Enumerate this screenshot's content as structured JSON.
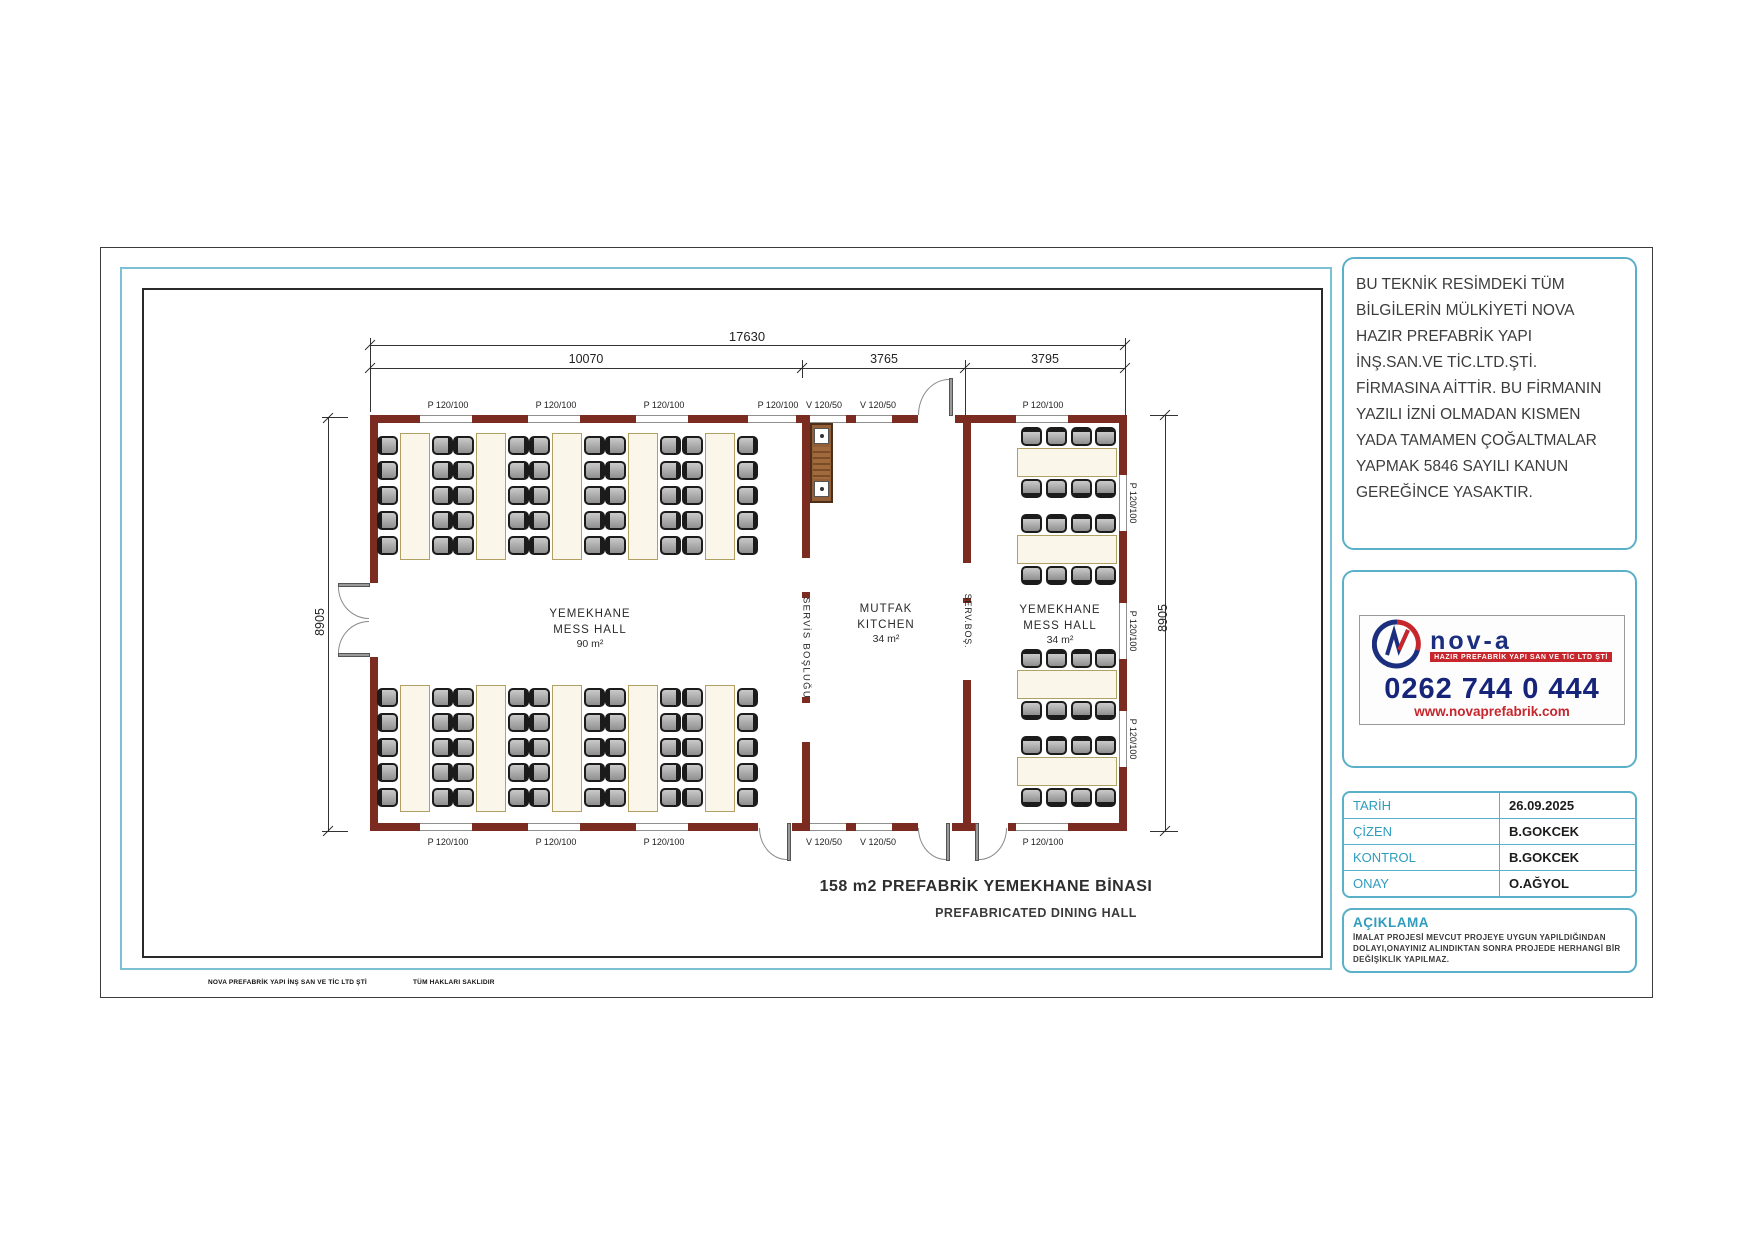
{
  "sheet": {
    "footer_left": "NOVA PREFABRİK YAPI İNŞ SAN VE TİC LTD ŞTİ",
    "footer_right": "TÜM HAKLARI SAKLIDIR"
  },
  "plan": {
    "title": "158 m2 PREFABRİK YEMEKHANE BİNASI",
    "subtitle": "PREFABRICATED DINING HALL",
    "dimensions": {
      "total_width": "17630",
      "left_width": "10070",
      "mid_width": "3765",
      "right_width": "3795",
      "left_height": "8905",
      "right_height": "8905"
    },
    "rooms": [
      {
        "name": "YEMEKHANE",
        "name_en": "MESS HALL",
        "area": "90 m²"
      },
      {
        "name": "MUTFAK",
        "name_en": "KITCHEN",
        "area": "34 m²"
      },
      {
        "name": "YEMEKHANE",
        "name_en": "MESS HALL",
        "area": "34 m²"
      }
    ],
    "corridors": [
      "SERVİS BOŞLUĞU",
      "SERV.BOŞ."
    ],
    "opening_labels": {
      "top_y": 400,
      "bottom_y": 837,
      "right_x": 1133,
      "top": [
        {
          "t": "P 120/100",
          "x": 448
        },
        {
          "t": "P 120/100",
          "x": 556
        },
        {
          "t": "P 120/100",
          "x": 664
        },
        {
          "t": "P 120/100",
          "x": 778
        },
        {
          "t": "V 120/50",
          "x": 824
        },
        {
          "t": "V 120/50",
          "x": 878
        },
        {
          "t": "P 120/100",
          "x": 1043
        }
      ],
      "bottom": [
        {
          "t": "P 120/100",
          "x": 448
        },
        {
          "t": "P 120/100",
          "x": 556
        },
        {
          "t": "P 120/100",
          "x": 664
        },
        {
          "t": "V 120/50",
          "x": 824
        },
        {
          "t": "V 120/50",
          "x": 878
        },
        {
          "t": "P 120/100",
          "x": 1043
        }
      ],
      "right": [
        {
          "t": "P 120/100",
          "y": 503
        },
        {
          "t": "P 120/100",
          "y": 631
        },
        {
          "t": "P 120/100",
          "y": 739
        }
      ]
    }
  },
  "furniture": {
    "left_hall": {
      "table_xs": [
        400,
        476,
        552,
        628,
        705
      ],
      "band_ys": [
        433,
        685
      ],
      "table_w": 30,
      "table_h": 127,
      "rows": 5,
      "row_dy": 25,
      "row_y0": 3,
      "left_dx": -23,
      "right_dx": 32
    },
    "right_hall": {
      "table_x": 1017,
      "table_ys": [
        448,
        535,
        670,
        757
      ],
      "table_w": 100,
      "table_h": 29,
      "chair_dxs": [
        4,
        29,
        54,
        78
      ],
      "top_dy": -21,
      "bottom_dy": 31
    }
  },
  "side_panel": {
    "copyright_text": "BU TEKNİK RESİMDEKİ TÜM BİLGİLERİN MÜLKİYETİ NOVA HAZIR PREFABRİK YAPI İNŞ.SAN.VE TİC.LTD.ŞTİ. FİRMASINA AİTTİR. BU FİRMANIN YAZILI İZNİ OLMADAN KISMEN YADA TAMAMEN ÇOĞALTMALAR YAPMAK 5846 SAYILI KANUN GEREĞİNCE YASAKTIR.",
    "logo": {
      "brand": "nov-a",
      "tagline": "HAZIR PREFABRİK YAPI SAN VE TİC LTD ŞTİ",
      "phone": "0262 744 0 444",
      "website": "www.novaprefabrik.com"
    },
    "info_table": {
      "rows": [
        {
          "label": "TARİH",
          "value": "26.09.2025"
        },
        {
          "label": "ÇİZEN",
          "value": "B.GOKCEK"
        },
        {
          "label": "KONTROL",
          "value": "B.GOKCEK"
        },
        {
          "label": "ONAY",
          "value": "O.AĞYOL"
        }
      ]
    },
    "note": {
      "title": "AÇIKLAMA",
      "body": "İMALAT PROJESİ MEVCUT PROJEYE UYGUN YAPILDIĞINDAN DOLAYI,ONAYINIZ ALINDIKTAN SONRA PROJEDE HERHANGİ BİR DEĞİŞİKLİK YAPILMAZ."
    }
  },
  "colors": {
    "wall": "#7b2b1f",
    "panel_border": "#5ab0c8",
    "label_teal": "#2f9cbe",
    "logo_navy": "#1b2f7e",
    "logo_red": "#c6262c"
  }
}
